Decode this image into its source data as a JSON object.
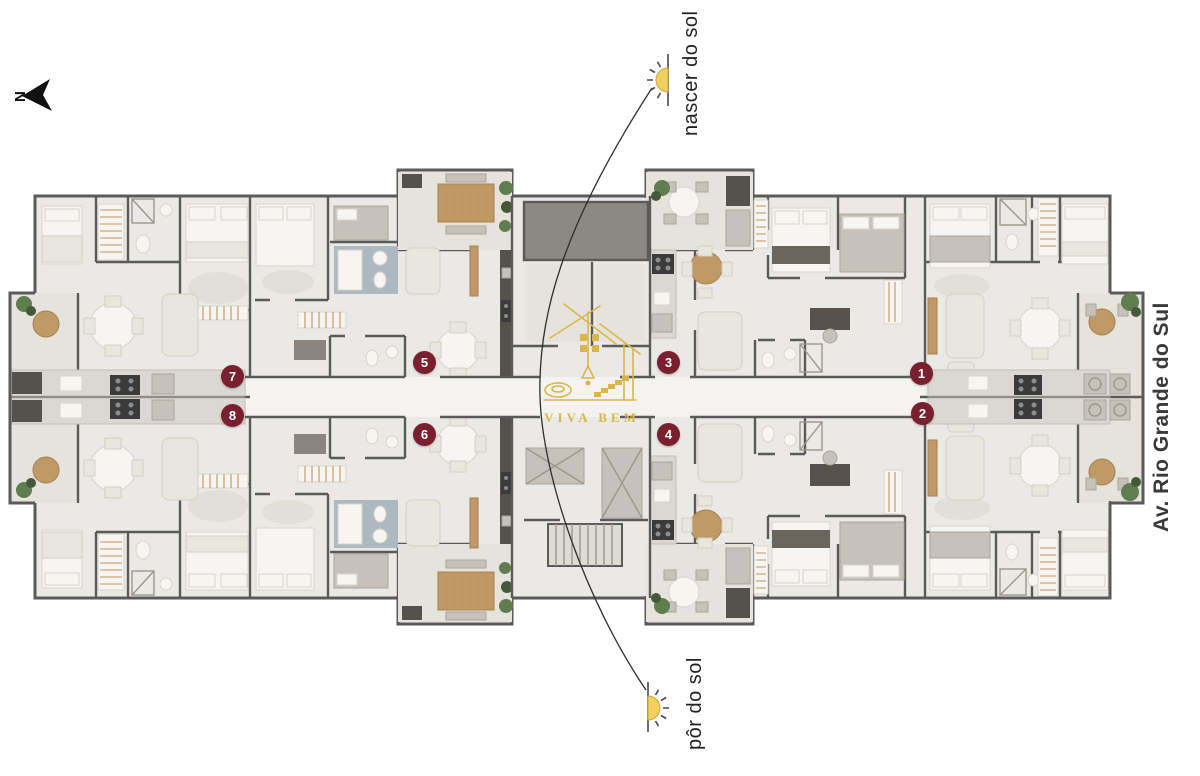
{
  "compass": {
    "label": "N"
  },
  "labels": {
    "sunrise": "nascer do sol",
    "sunset": "pôr do sol",
    "street": "Av. Rio Grande do Sul"
  },
  "logo": {
    "text": "VIVA BEM"
  },
  "units": [
    {
      "number": "1"
    },
    {
      "number": "2"
    },
    {
      "number": "3"
    },
    {
      "number": "4"
    },
    {
      "number": "5"
    },
    {
      "number": "6"
    },
    {
      "number": "7"
    },
    {
      "number": "8"
    }
  ],
  "colors": {
    "wall": "#5a5a5a",
    "floor": "#ebe9e5",
    "floor_light": "#f4f3f0",
    "floor_dark": "#e6e3dd",
    "dark_block": "#8c8882",
    "appliance": "#3b3b3b",
    "counter": "#dbd8d3",
    "wood": "#c09a66",
    "plant": "#5f7d4f",
    "plant_dark": "#43593a",
    "white_furniture": "#f6f5f2",
    "beige": "#e9e6df",
    "gray_furniture": "#c6c2bb",
    "badge": "#7a1f2d",
    "gold": "#d9b64a",
    "sun": "#f3cf5e",
    "line": "#2f2f2f",
    "street_text": "#3a3a3a",
    "label_text": "#222222"
  }
}
